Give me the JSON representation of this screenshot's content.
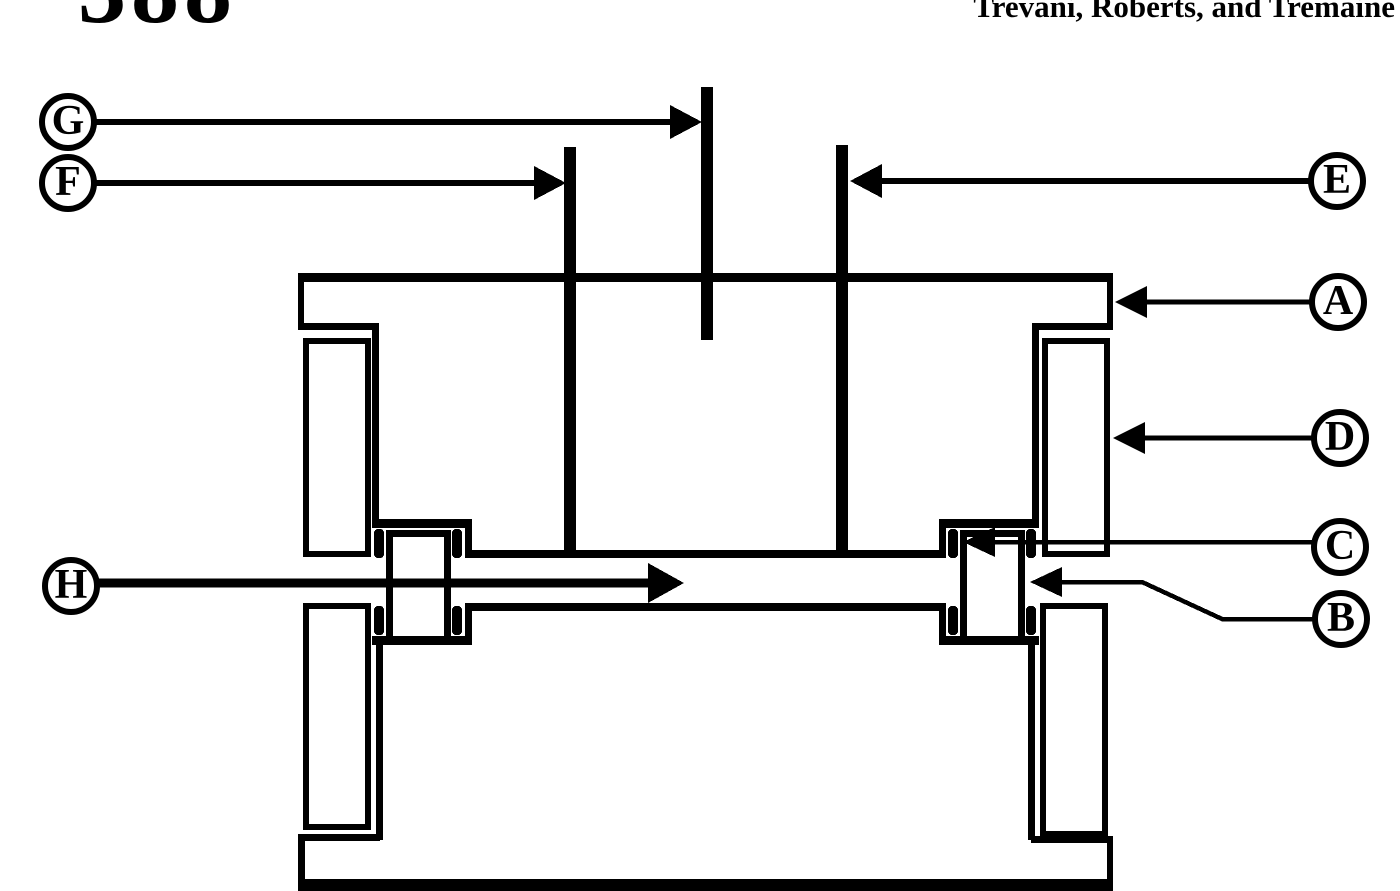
{
  "colors": {
    "ink": "#000000",
    "paper": "#ffffff"
  },
  "header": {
    "page_number": "388",
    "running_head": "Trevani, Roberts, and Tremaine"
  },
  "figure": {
    "labels": {
      "a": "A",
      "b": "B",
      "c": "C",
      "d": "D",
      "e": "E",
      "f": "F",
      "g": "G",
      "h": "H"
    }
  }
}
